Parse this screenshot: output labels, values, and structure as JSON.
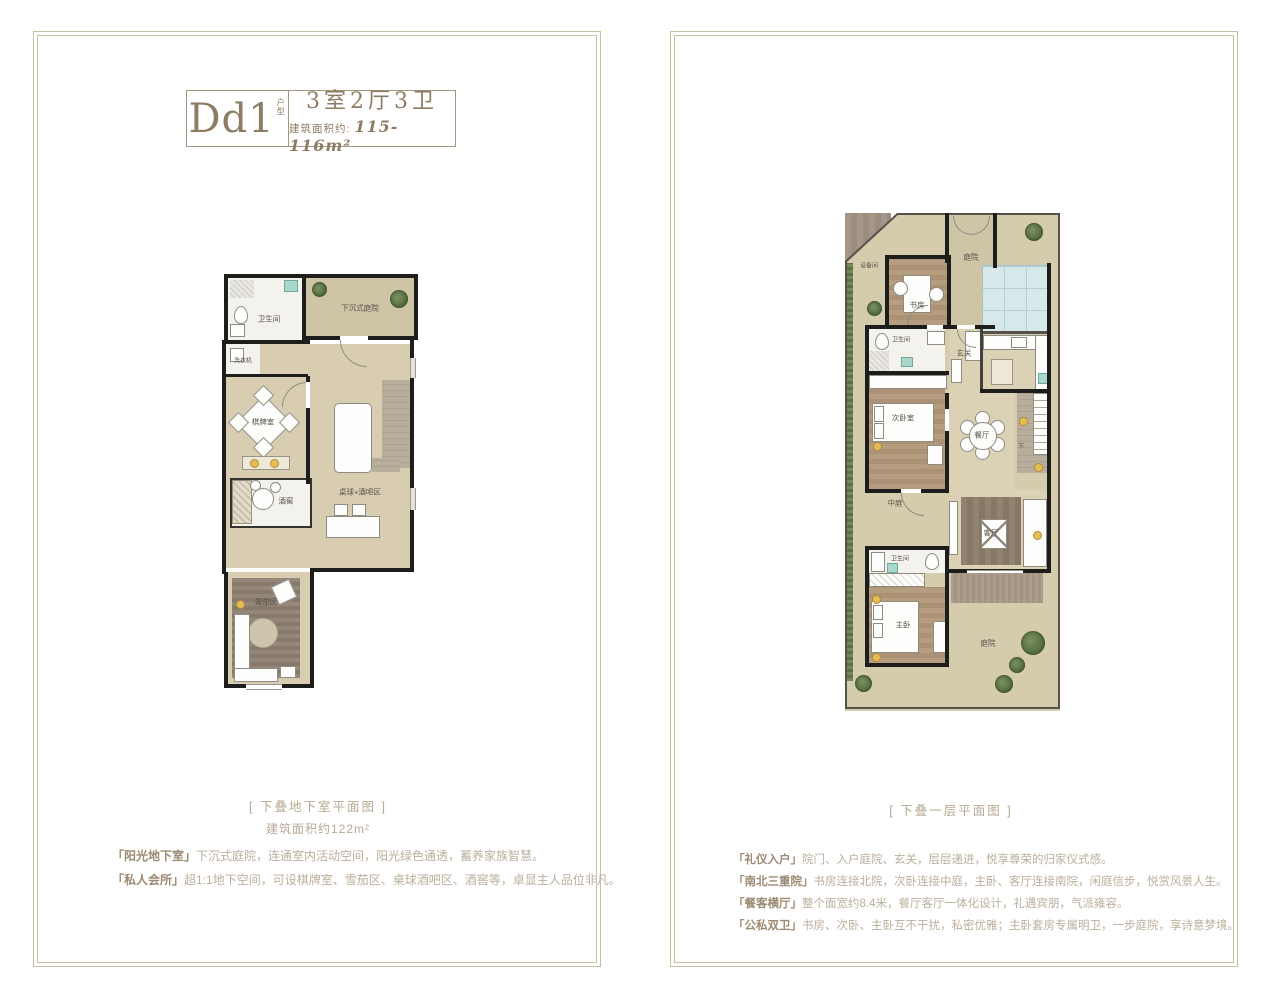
{
  "unit": {
    "code": "Dd1",
    "code_suffix": "户型",
    "spec": "3室2厅3卫",
    "area_label": "建筑面积约:",
    "area_value": "115-116m²"
  },
  "left_panel": {
    "caption": "[ 下叠地下室平面图 ]",
    "subcaption": "建筑面积约122m²",
    "features": [
      {
        "tag": "「阳光地下室」",
        "text": "下沉式庭院，连通室内活动空间，阳光绿色通透，蓄养家族智慧。"
      },
      {
        "tag": "「私人会所」",
        "text": "超1:1地下空间，可设棋牌室、雪茄区、桌球酒吧区、酒窖等，卓显主人品位非凡。"
      }
    ],
    "rooms": {
      "bathroom": "卫生间",
      "sunken_yard": "下沉式庭院",
      "laundry": "洗衣机",
      "chess_room": "棋牌室",
      "wine_cellar": "酒窖",
      "billiard_bar": "桌球+酒吧区",
      "cigar_room": "雪茄区"
    }
  },
  "right_panel": {
    "caption": "[ 下叠一层平面图 ]",
    "features": [
      {
        "tag": "「礼仪入户」",
        "text": "院门、入户庭院、玄关，层层递进，悦享尊荣的归家仪式感。"
      },
      {
        "tag": "「南北三重院」",
        "text": "书房连接北院，次卧连接中庭，主卧、客厅连接南院，闲庭信步，悦赏风景人生。"
      },
      {
        "tag": "「餐客横厅」",
        "text": "整个面宽约8.4米，餐厅客厅一体化设计，礼遇宾朋，气派雍容。"
      },
      {
        "tag": "「公私双卫」",
        "text": "书房、次卧、主卧互不干扰，私密优雅；主卧套房专属明卫，一步庭院，享诗意梦境。"
      }
    ],
    "rooms": {
      "equipment_room": "设备间",
      "study": "书房",
      "entry_yard": "庭院",
      "bathroom_1": "卫生间",
      "foyer": "玄关",
      "second_bedroom": "次卧室",
      "dining": "餐厅",
      "stairs_down": "下",
      "living": "客厅",
      "middle_yard": "中庭",
      "bathroom_2": "卫生间",
      "master_bedroom": "主卧",
      "south_yard": "庭院"
    }
  },
  "colors": {
    "accent_brown": "#8d7b63",
    "text_light": "#b6a993",
    "frame": "#c8c1a0",
    "wall": "#1d1d1b",
    "floor_beige": "#d8cdb1",
    "wood": "#b2987c",
    "pool_blue": "#d6e8ea",
    "plant_green": "#5d7045"
  }
}
